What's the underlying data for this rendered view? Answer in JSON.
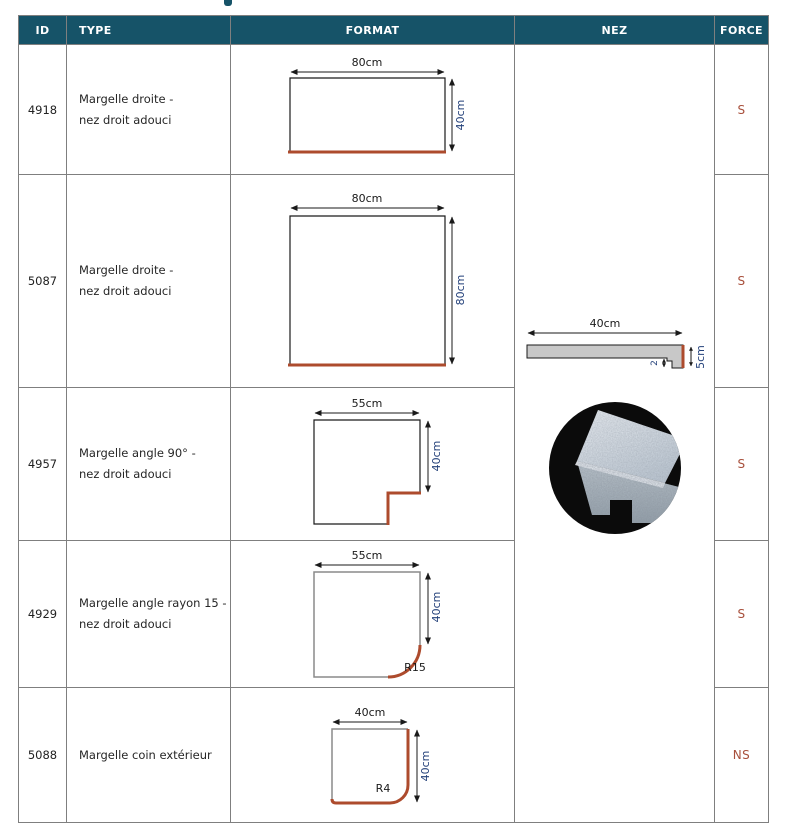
{
  "colors": {
    "header_bg": "#165368",
    "border_gray": "#7f7f7f",
    "accent_red": "#ad4b2d",
    "force_red": "#a8503c",
    "dim_label_blue": "#24417a",
    "photo_bg": "#0b0b0b"
  },
  "table": {
    "headers": [
      "ID",
      "TYPE",
      "FORMAT",
      "NEZ",
      "FORCE"
    ],
    "nez": {
      "width_label": "40cm",
      "thickness_label": "5cm",
      "groove_label": "2"
    },
    "rows": [
      {
        "id": "4918",
        "type": [
          "Margelle droite -",
          "nez droit adouci"
        ],
        "force": "S",
        "dims": {
          "width": "80cm",
          "height": "40cm"
        }
      },
      {
        "id": "5087",
        "type": [
          "Margelle droite -",
          "nez droit adouci"
        ],
        "force": "S",
        "dims": {
          "width": "80cm",
          "height": "80cm"
        }
      },
      {
        "id": "4957",
        "type": [
          "Margelle angle 90° -",
          "nez droit adouci"
        ],
        "force": "S",
        "dims": {
          "width": "55cm",
          "height": "40cm"
        }
      },
      {
        "id": "4929",
        "type": [
          "Margelle angle rayon 15 -",
          "nez droit adouci"
        ],
        "force": "S",
        "dims": {
          "width": "55cm",
          "height": "40cm",
          "radius": "R15"
        }
      },
      {
        "id": "5088",
        "type": [
          "Margelle coin extérieur"
        ],
        "force": "NS",
        "dims": {
          "width": "40cm",
          "height": "40cm",
          "radius": "R4"
        }
      }
    ]
  }
}
